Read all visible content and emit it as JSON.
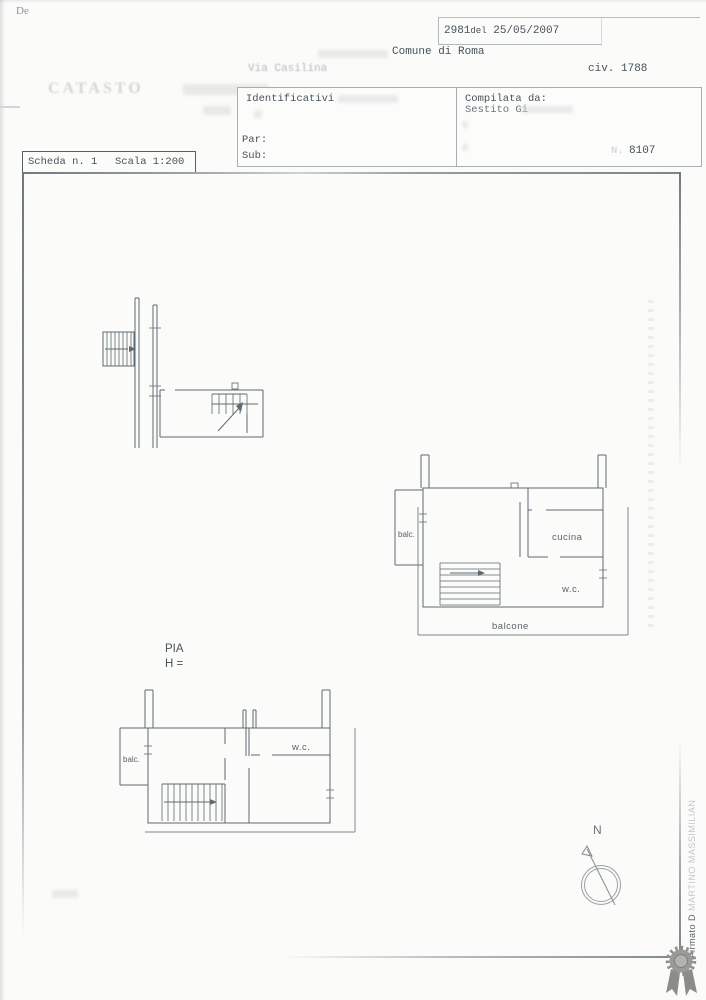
{
  "document": {
    "corner_mark": "De",
    "watermark": "CATASTO",
    "protocol": {
      "number": "2981",
      "del": "del",
      "date": "25/05/2007"
    },
    "comune": "Comune di Roma",
    "street": "Via Casilina",
    "civico": "civ. 1788",
    "identificativi_label": "Identificativi",
    "par_label": "Par:",
    "sub_label": "Sub:",
    "compilata_label": "Compilata da:",
    "compilata_name": "Sestito Gi",
    "sheet_no_label": "N.",
    "sheet_no": "8107",
    "scheda_label": "Scheda n. 1",
    "scala_label": "Scala 1:200"
  },
  "plans": {
    "upper_floor": {
      "balc": "balc.",
      "cucina": "cucina",
      "wc": "w.c.",
      "balcone": "balcone"
    },
    "lower_floor": {
      "balc": "balc.",
      "wc": "w.c."
    },
    "caption": {
      "line1": "PIA",
      "line2": "H ="
    }
  },
  "compass": {
    "label": "N"
  },
  "signature": {
    "visible": "Firmato D",
    "faint": "MARTINO MASSIMILIAN"
  },
  "colors": {
    "ink": "#47525a",
    "plan_line": "#5e6a72",
    "seal_gray": "#8f8f8d"
  }
}
